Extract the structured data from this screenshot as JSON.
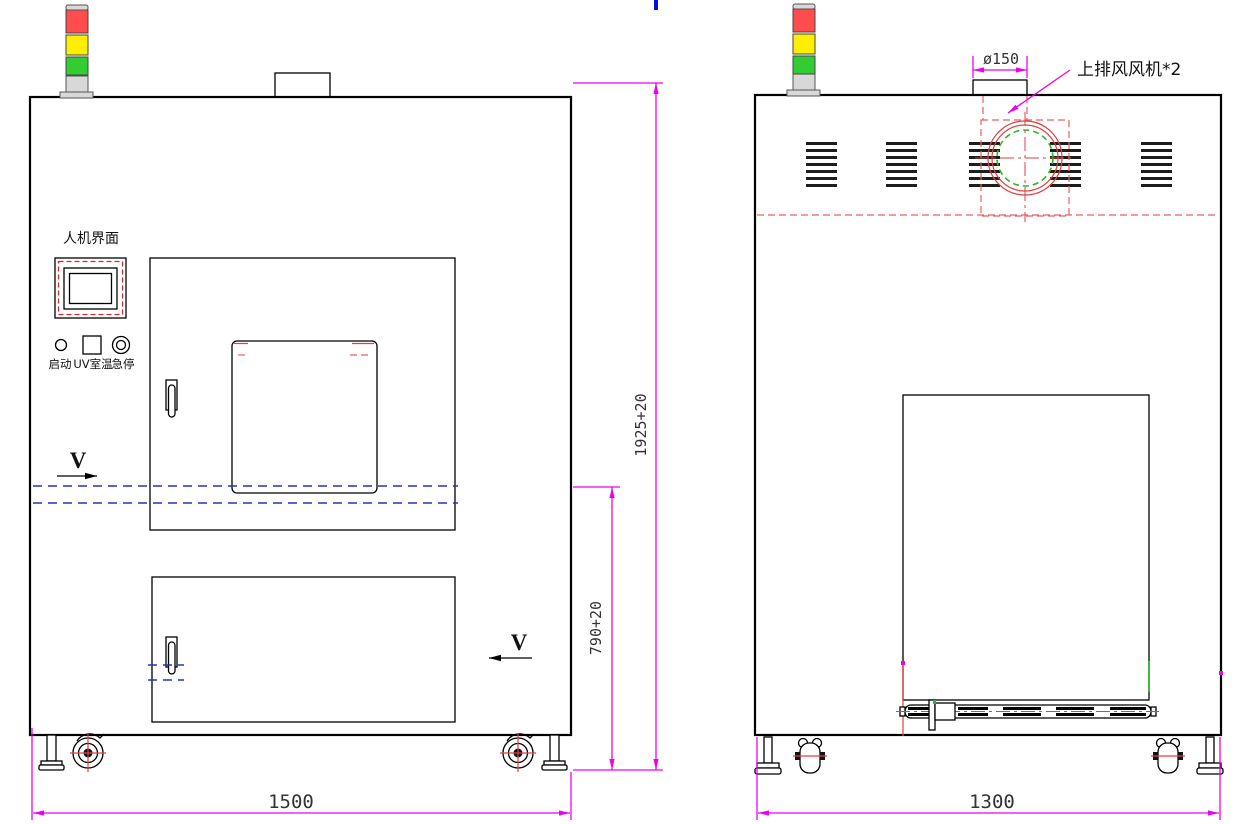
{
  "front": {
    "hmi_label": "人机界面",
    "btn_start": "启动",
    "btn_uv": "UV室温",
    "btn_estop": "急停",
    "section_marker": "V",
    "dim_height": "1925+20",
    "dim_belt": "790+20",
    "dim_width": "1500"
  },
  "side": {
    "dia": "ø150",
    "fan_note": "上排风风机*2",
    "dim_width": "1300"
  },
  "colors": {
    "dimension_magenta": "#ee00ee",
    "centerline_red": "#e04040",
    "phantom_blue": "#2233bb",
    "fan_green": "#2bb52b",
    "tower_red": "#ff4d4d",
    "tower_yellow": "#ffee00",
    "tower_green": "#33cc33"
  }
}
